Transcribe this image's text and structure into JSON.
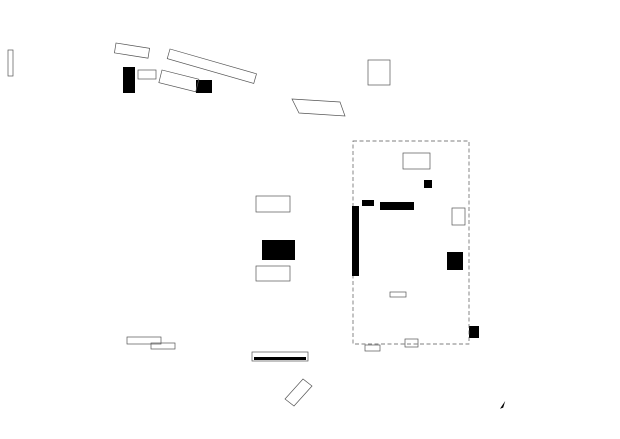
{
  "colors": {
    "paper": "#ffffff",
    "ink": "#1b1b1b",
    "context": "#a9a9a9",
    "tree": "#c6c6c6",
    "fill_light": "#dedede",
    "fill_mid": "#8f8f8f",
    "ramp": "#b4b4b4"
  },
  "scale_bar": {
    "tick_labels": [
      "0",
      "2",
      "4",
      "6",
      "8",
      "10"
    ],
    "end_label": "20m"
  },
  "generators": {
    "trees_context": {
      "type": "trees",
      "item_name": "tree",
      "items": [
        [
          27,
          20,
          10
        ],
        [
          63,
          16,
          11
        ],
        [
          78,
          71,
          13
        ],
        [
          80,
          190,
          12
        ],
        [
          70,
          253,
          12
        ],
        [
          74,
          306,
          12
        ],
        [
          58,
          368,
          13
        ],
        [
          22,
          407,
          13
        ],
        [
          157,
          385,
          15
        ],
        [
          262,
          393,
          14
        ],
        [
          375,
          33,
          14
        ],
        [
          471,
          30,
          11
        ],
        [
          478,
          85,
          25
        ],
        [
          603,
          88,
          17
        ],
        [
          545,
          157,
          14
        ],
        [
          501,
          155,
          13
        ],
        [
          503,
          182,
          13
        ],
        [
          501,
          232,
          13
        ],
        [
          545,
          357,
          12
        ],
        [
          600,
          332,
          12
        ]
      ]
    },
    "trees_median": {
      "type": "trees",
      "item_name": "tree",
      "items": [
        [
          302,
          163,
          13
        ],
        [
          302,
          208,
          13
        ],
        [
          302,
          253,
          13
        ],
        [
          302,
          298,
          13
        ],
        [
          302,
          343,
          13
        ],
        [
          337,
          200,
          13
        ],
        [
          337,
          245,
          13
        ],
        [
          337,
          290,
          13
        ],
        [
          337,
          335,
          13
        ]
      ]
    },
    "trees_plaza": {
      "type": "trees",
      "item_name": "tree",
      "items": [
        [
          342,
          366,
          6
        ],
        [
          365,
          370,
          12
        ],
        [
          420,
          372,
          13
        ],
        [
          452,
          370,
          13
        ]
      ]
    },
    "tree_pits": {
      "type": "rects",
      "item_name": "tree-pit",
      "cls": "pit",
      "items": [
        [
          297.5,
          158.5,
          9,
          8
        ],
        [
          297.5,
          203.5,
          9,
          8
        ],
        [
          297.5,
          248.5,
          9,
          8
        ],
        [
          297.5,
          293.5,
          9,
          8
        ],
        [
          297.5,
          338.5,
          9,
          8
        ],
        [
          332.5,
          195.5,
          9,
          8
        ],
        [
          332.5,
          240.5,
          9,
          8
        ],
        [
          332.5,
          285.5,
          9,
          8
        ],
        [
          332.5,
          330.5,
          9,
          8
        ]
      ]
    },
    "hall_columns": {
      "type": "dots",
      "item_name": "column-dot",
      "xs": [
        152,
        187,
        221
      ],
      "ys": [
        103,
        133,
        163,
        193,
        223,
        253,
        283
      ],
      "r": 1.2
    },
    "parking_rungs": {
      "type": "hlines",
      "item_name": "parking-stall-line",
      "x0": 489,
      "x1": 511,
      "y0": 96,
      "step": 8.7,
      "count": 30,
      "cls": "ctx2"
    },
    "bike_hoops": {
      "type": "rackpairs",
      "item_name": "bike-stand",
      "y0": 129,
      "step": 5.0,
      "count": 16,
      "x1": 334.5,
      "x2": 339.7,
      "w": 4.2,
      "h": 2
    },
    "colonnade": {
      "type": "circlerow",
      "item_name": "column",
      "x0": 383.5,
      "step": 6.6,
      "count": 5,
      "cy": 206.5,
      "r": 2.5
    },
    "seating": {
      "type": "rectrow",
      "item_name": "seating-unit",
      "x0": 368,
      "y": 285.5,
      "step": 7.2,
      "count": 9,
      "w": 5,
      "h": 7,
      "cls": "w4"
    },
    "window_ticks_right": {
      "type": "tickrow",
      "item_name": "window-tick",
      "x0": 362.5,
      "y0": 147,
      "xstep": 4.6,
      "ystep": 0,
      "count": 8,
      "dx": 0,
      "dy": 6,
      "cls": "w4"
    },
    "wall_ticks_left": {
      "type": "tickrow",
      "item_name": "facade-tick",
      "x0": 119.5,
      "y0": 104,
      "xstep": 0,
      "ystep": 24,
      "count": 10,
      "dx": 4,
      "dy": 0,
      "cls": "ctx2"
    },
    "street_ticks": {
      "type": "tickrow",
      "item_name": "street-tick",
      "x0": 323,
      "y0": 77.5,
      "xstep": 4,
      "ystep": 0,
      "count": 9,
      "dx": 1.6,
      "dy": 3.2,
      "cls": "ctx2"
    },
    "shrub_cluster": {
      "type": "circles",
      "item_name": "shrub",
      "r": 2.2,
      "items": [
        [
          431,
          109
        ],
        [
          437,
          105
        ],
        [
          443,
          111
        ],
        [
          434,
          116
        ],
        [
          440,
          119
        ],
        [
          430,
          122
        ],
        [
          444,
          124
        ]
      ]
    },
    "stair_lines_rb": {
      "type": "hlines",
      "item_name": "stair-step",
      "x0": 448,
      "x1": 462,
      "y0": 254,
      "step": 3.4,
      "count": 5,
      "cls": "w4"
    },
    "scale_labels": {
      "type": "labels",
      "item_name": "scale-label",
      "x0": 520.5,
      "step": 5.7,
      "y": 404.5,
      "from": "scale_bar.tick_labels"
    }
  }
}
